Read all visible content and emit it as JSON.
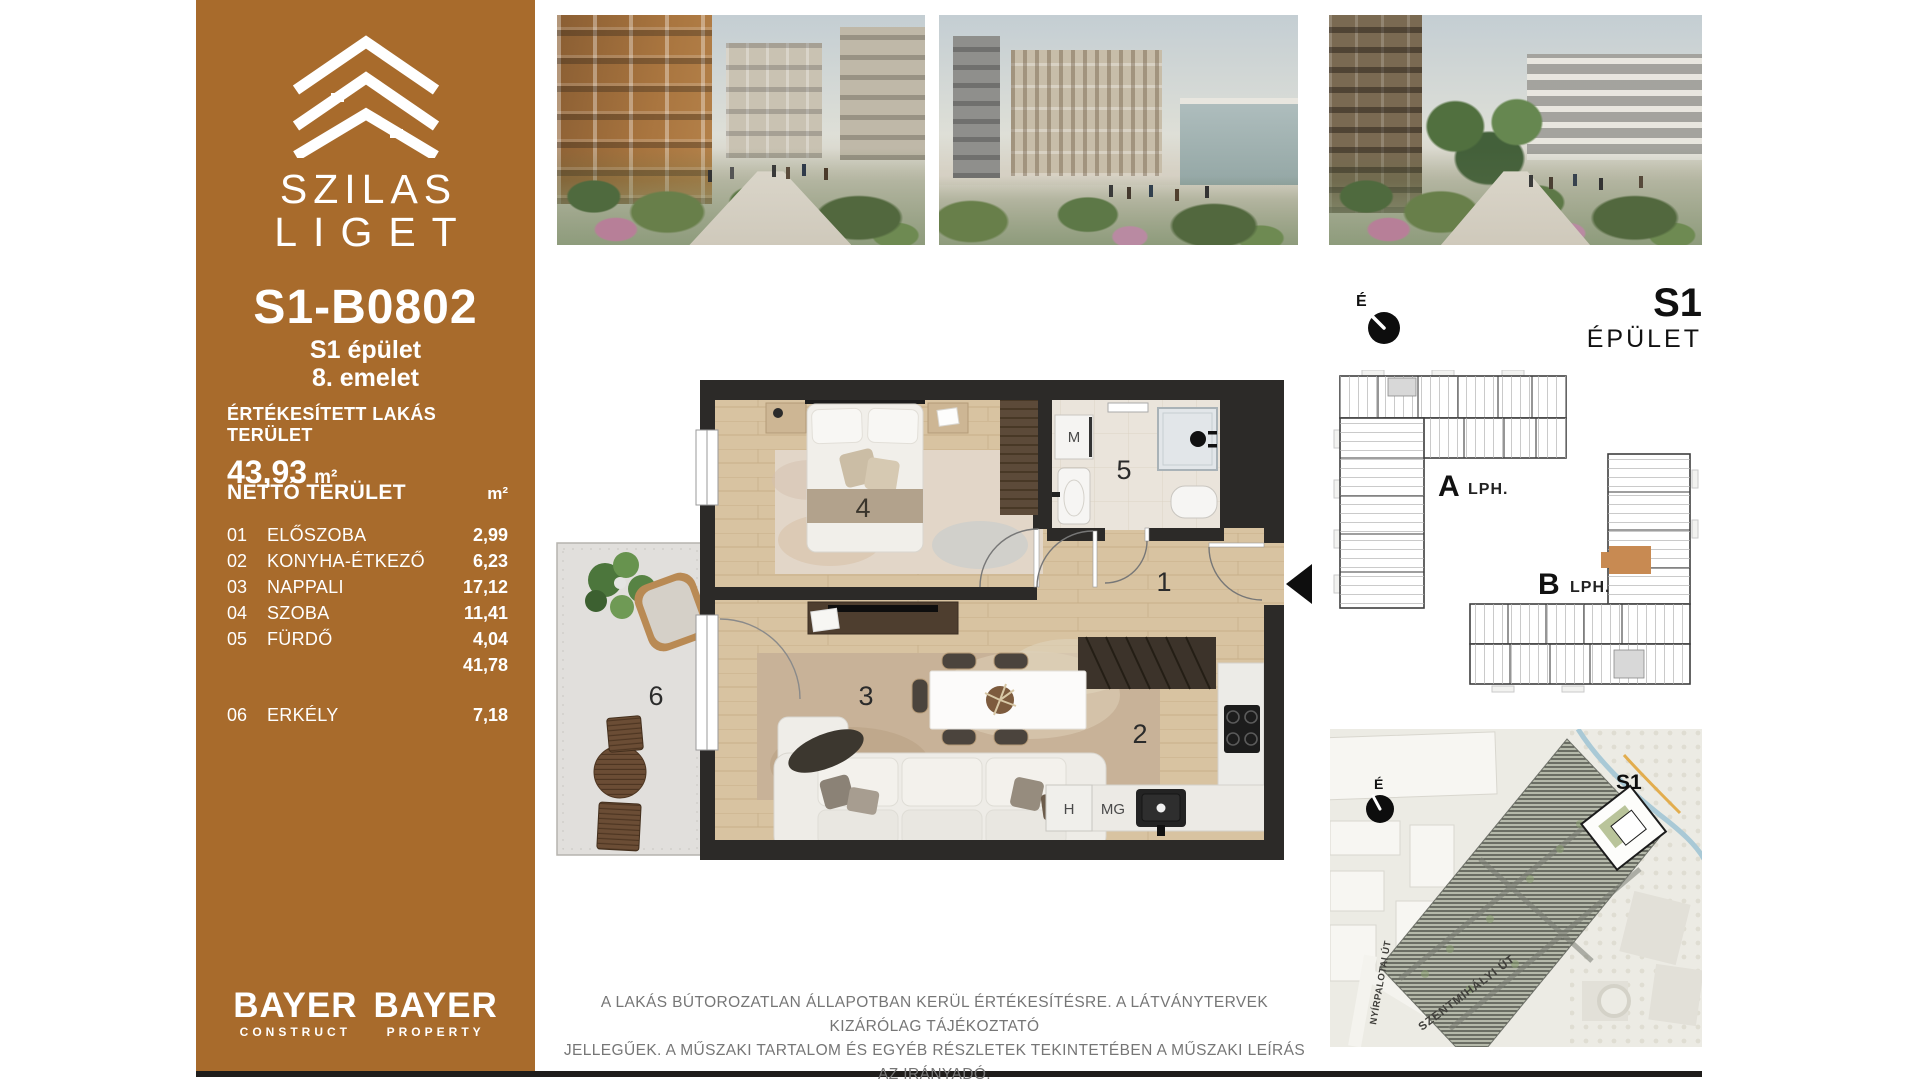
{
  "brand": {
    "line1": "SZILAS",
    "line2": "LIGET"
  },
  "sidebar": {
    "unit_id": "S1-B0802",
    "building": "S1 épület",
    "floor": "8. emelet",
    "sold_label": "ÉRTÉKESÍTETT LAKÁS TERÜLET",
    "sold_value": "43,93",
    "sold_unit": "m²",
    "net_label": "NETTÓ TERÜLET",
    "net_unit": "m²",
    "rooms": [
      {
        "num": "01",
        "name": "ELŐSZOBA",
        "area": "2,99"
      },
      {
        "num": "02",
        "name": "KONYHA-ÉTKEZŐ",
        "area": "6,23"
      },
      {
        "num": "03",
        "name": "NAPPALI",
        "area": "17,12"
      },
      {
        "num": "04",
        "name": "SZOBA",
        "area": "11,41"
      },
      {
        "num": "05",
        "name": "FÜRDŐ",
        "area": "4,04"
      }
    ],
    "net_total": "41,78",
    "balcony": {
      "num": "06",
      "name": "ERKÉLY",
      "area": "7,18"
    },
    "logo1": {
      "top": "BAYER",
      "bottom": "CONSTRUCT"
    },
    "logo2": {
      "top": "BAYER",
      "bottom": "PROPERTY"
    }
  },
  "floorplan": {
    "numbers": {
      "hall": "1",
      "kitchen": "2",
      "living": "3",
      "bedroom": "4",
      "bath": "5",
      "balcony": "6"
    },
    "appliances": {
      "washer": "M",
      "fridge": "H",
      "dishwasher": "MG"
    }
  },
  "building_plan": {
    "north": "É",
    "code": "S1",
    "label": "ÉPÜLET",
    "stair_a": "A",
    "stair_a_sfx": "LPH.",
    "stair_b": "B",
    "stair_b_sfx": "LPH.",
    "highlight_color": "#C88A52"
  },
  "site_map": {
    "north": "É",
    "code": "S1",
    "street_vert": "NYÍRPALOTAI ÚT",
    "street_diag": "SZENTMIHÁLYI ÚT"
  },
  "disclaimer": {
    "line1": "A LAKÁS BÚTOROZATLAN ÁLLAPOTBAN KERÜL ÉRTÉKESÍTÉSRE. A LÁTVÁNYTERVEK KIZÁRÓLAG TÁJÉKOZTATÓ",
    "line2": "JELLEGŰEK. A MŰSZAKI TARTALOM ÉS EGYÉB RÉSZLETEK TEKINTETÉBEN A MŰSZAKI LEÍRÁS AZ IRÁNYADÓ."
  },
  "colors": {
    "sidebar": "#A86B2C",
    "accent_unit": "#C88A52",
    "wall": "#2C2A28"
  }
}
